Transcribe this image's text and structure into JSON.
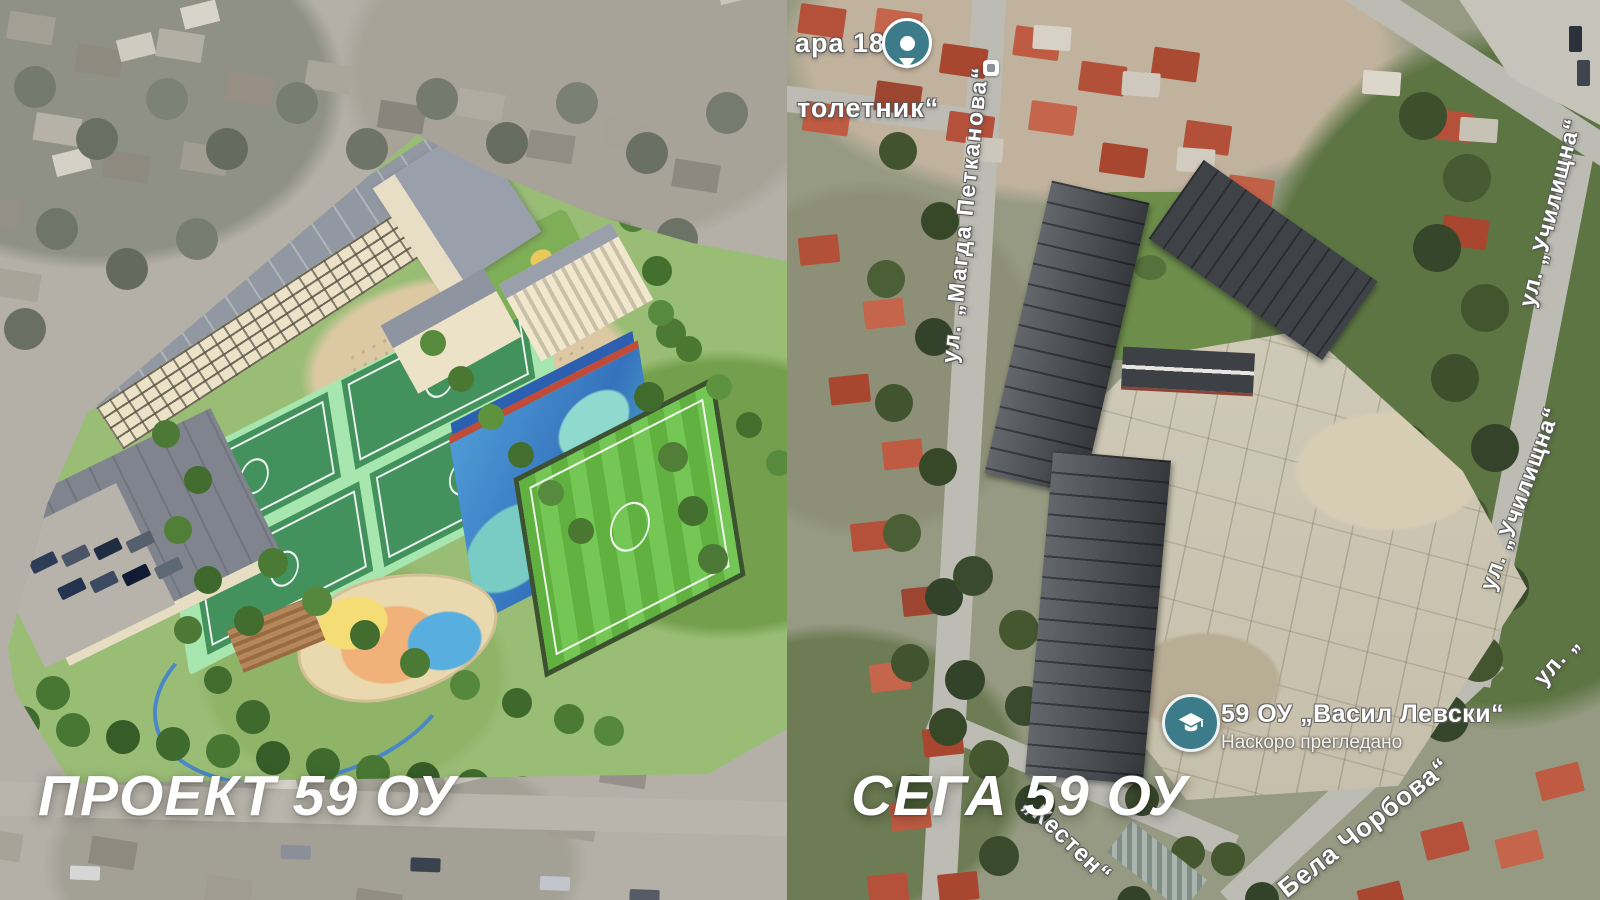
{
  "left": {
    "caption": "ПРОЕКТ 59 ОУ"
  },
  "right": {
    "caption": "СЕГА 59 ОУ",
    "colors": {
      "poi_teal": "#3c7b89"
    },
    "pin": {
      "label": "ара 18"
    },
    "streets": [
      {
        "text": "толетник“"
      },
      {
        "text": "ул. „Магда Петканова“"
      },
      {
        "text": "ул. „Училищна“"
      },
      {
        "text": "ул. „Училищна“"
      },
      {
        "text": "ул. „"
      },
      {
        "text": "„Кестен“"
      },
      {
        "text": "Бела Чорбова“"
      }
    ],
    "school_poi": {
      "name": "59 ОУ „Васил Левски“",
      "status": "Наскоро прегледано"
    }
  }
}
